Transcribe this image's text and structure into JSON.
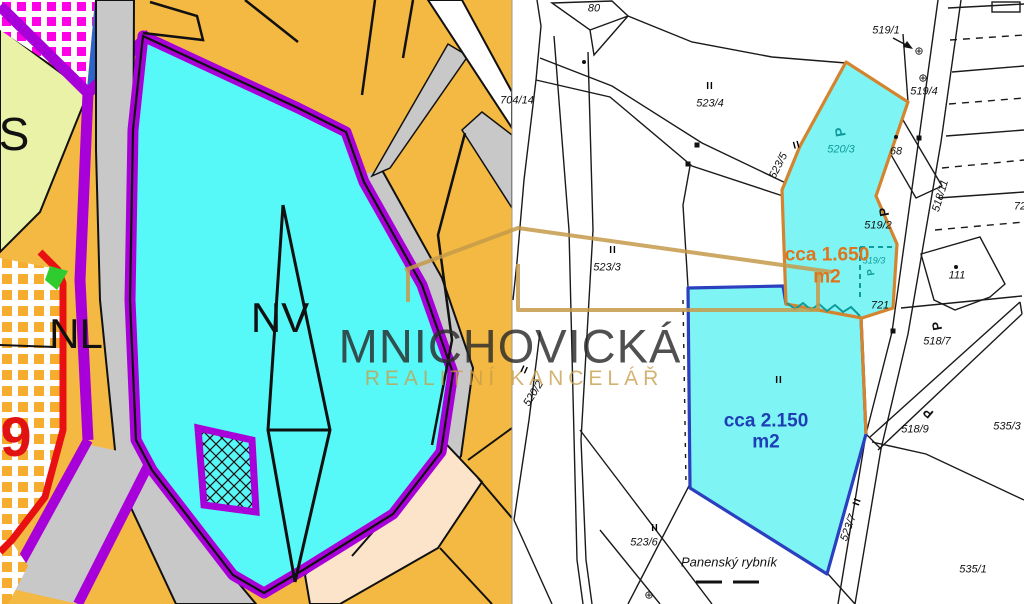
{
  "watermark": {
    "line1": "MNICHOVICKÁ",
    "line2": "REALITNÍ KANCELÁŘ",
    "text_color": "#2a2a2a",
    "accent_color": "#c69e4a"
  },
  "left_map": {
    "kind": "zoning-plan",
    "colors": {
      "orange": "#f4b942",
      "cyan": "#57f8f8",
      "purple": "#a800d8",
      "red": "#e81010",
      "gray": "#c8c8c8",
      "green": "#2ecc2e",
      "yellow_green": "#e9f2a6",
      "peach": "#fbe4ca",
      "magenta_checker": "#ff00e6",
      "orange_checker": "#f5ac2f",
      "blue_sliver": "#2e64c8"
    },
    "labels": [
      {
        "t": "S",
        "x": 14,
        "y": 134,
        "s": 46
      },
      {
        "t": "NL",
        "x": 76,
        "y": 334,
        "s": 42
      },
      {
        "t": "9",
        "x": 16,
        "y": 437,
        "s": 56,
        "b": 1,
        "c": "#e01212"
      },
      {
        "t": "NV",
        "x": 280,
        "y": 318,
        "s": 42
      }
    ]
  },
  "right_map": {
    "kind": "cadastral-map",
    "colors": {
      "highlight_fill": "#7ff4f4",
      "outline_orange": "#d4842f",
      "outline_blue": "#2b3fbf",
      "teal": "#0f9b9b",
      "area_text_orange": "#e0741c",
      "area_text_blue": "#1d3eb5"
    },
    "areas": [
      {
        "name": "upper-parcel",
        "label": "cca 1.650 m2",
        "outline": "#d4842f"
      },
      {
        "name": "lower-parcel",
        "label": "cca 2.150 m2",
        "outline": "#2b3fbf"
      }
    ],
    "labels": [
      {
        "t": "80",
        "x": 594,
        "y": 9,
        "i": 1
      },
      {
        "t": "704/14",
        "x": 517,
        "y": 101,
        "i": 1
      },
      {
        "t": "523/4",
        "x": 710,
        "y": 104,
        "i": 1
      },
      {
        "t": "519/1",
        "x": 886,
        "y": 31,
        "i": 1
      },
      {
        "t": "519/4",
        "x": 924,
        "y": 92,
        "i": 1
      },
      {
        "t": "519/2",
        "x": 878,
        "y": 226,
        "i": 1
      },
      {
        "t": "520/3",
        "x": 841,
        "y": 150,
        "i": 1,
        "c": "#0f9b9b"
      },
      {
        "t": "519/3",
        "x": 874,
        "y": 261,
        "s": 9,
        "i": 1,
        "c": "#0f9b9b"
      },
      {
        "t": "68",
        "x": 896,
        "y": 152,
        "i": 1
      },
      {
        "t": "721",
        "x": 880,
        "y": 306,
        "i": 1
      },
      {
        "t": "111",
        "x": 957,
        "y": 276,
        "i": 1
      },
      {
        "t": "72",
        "x": 1020,
        "y": 207,
        "i": 1
      },
      {
        "t": "518/11",
        "x": 941,
        "y": 196,
        "r": -73,
        "i": 1
      },
      {
        "t": "523/5",
        "x": 779,
        "y": 166,
        "r": -63,
        "i": 1
      },
      {
        "t": "520/2",
        "x": 534,
        "y": 394,
        "r": -58,
        "i": 1
      },
      {
        "t": "518/7",
        "x": 937,
        "y": 342,
        "i": 1
      },
      {
        "t": "518/9",
        "x": 915,
        "y": 430,
        "i": 1
      },
      {
        "t": "535/3",
        "x": 1007,
        "y": 427,
        "i": 1
      },
      {
        "t": "535/1",
        "x": 973,
        "y": 570,
        "i": 1
      },
      {
        "t": "523/6",
        "x": 644,
        "y": 543,
        "i": 1
      },
      {
        "t": "523/3",
        "x": 607,
        "y": 268,
        "i": 1
      },
      {
        "t": "523/7",
        "x": 849,
        "y": 528,
        "r": -70,
        "i": 1
      },
      {
        "t": "Panenský rybník",
        "x": 729,
        "y": 562,
        "s": 13,
        "i": 1
      },
      {
        "t": "cca 1.650",
        "x": 827,
        "y": 255,
        "s": 19,
        "b": 1,
        "c": "#e0741c"
      },
      {
        "t": "m2",
        "x": 827,
        "y": 277,
        "s": 19,
        "b": 1,
        "c": "#e0741c"
      },
      {
        "t": "cca 2.150",
        "x": 766,
        "y": 421,
        "s": 19,
        "b": 1,
        "c": "#1d3eb5"
      },
      {
        "t": "m2",
        "x": 766,
        "y": 442,
        "s": 19,
        "b": 1,
        "c": "#1d3eb5"
      }
    ],
    "symbols": [
      {
        "type": "pipes",
        "x": 710,
        "y": 87
      },
      {
        "type": "pipes",
        "x": 613,
        "y": 251
      },
      {
        "type": "pipes",
        "x": 779,
        "y": 381
      },
      {
        "type": "pipes",
        "x": 655,
        "y": 529
      },
      {
        "type": "pipes",
        "x": 858,
        "y": 502,
        "r": -70
      },
      {
        "type": "pipes",
        "x": 797,
        "y": 146,
        "r": -15
      },
      {
        "type": "pipes",
        "x": 524,
        "y": 371,
        "r": 25
      },
      {
        "type": "oplus",
        "x": 919,
        "y": 52
      },
      {
        "type": "oplus",
        "x": 923,
        "y": 79
      },
      {
        "type": "oplus",
        "x": 649,
        "y": 596
      },
      {
        "type": "tree",
        "x": 840,
        "y": 132,
        "r": -100,
        "s": 14,
        "c": "#0f9b9b"
      },
      {
        "type": "tree",
        "x": 884,
        "y": 212,
        "r": -100
      },
      {
        "type": "tree",
        "x": 937,
        "y": 326,
        "r": -100
      },
      {
        "type": "tree",
        "x": 928,
        "y": 413,
        "r": -140
      },
      {
        "type": "tree",
        "x": 872,
        "y": 272,
        "r": -100,
        "s": 10,
        "c": "#0f9b9b"
      },
      {
        "type": "dot",
        "x": 584,
        "y": 62
      },
      {
        "type": "dot",
        "x": 896,
        "y": 137
      },
      {
        "type": "dot",
        "x": 956,
        "y": 267
      },
      {
        "type": "sq",
        "x": 697,
        "y": 145
      },
      {
        "type": "sq",
        "x": 688,
        "y": 164
      },
      {
        "type": "sq",
        "x": 919,
        "y": 138
      },
      {
        "type": "sq",
        "x": 893,
        "y": 331
      },
      {
        "type": "dash",
        "x": 709,
        "y": 582
      },
      {
        "type": "dash",
        "x": 746,
        "y": 582
      }
    ]
  }
}
